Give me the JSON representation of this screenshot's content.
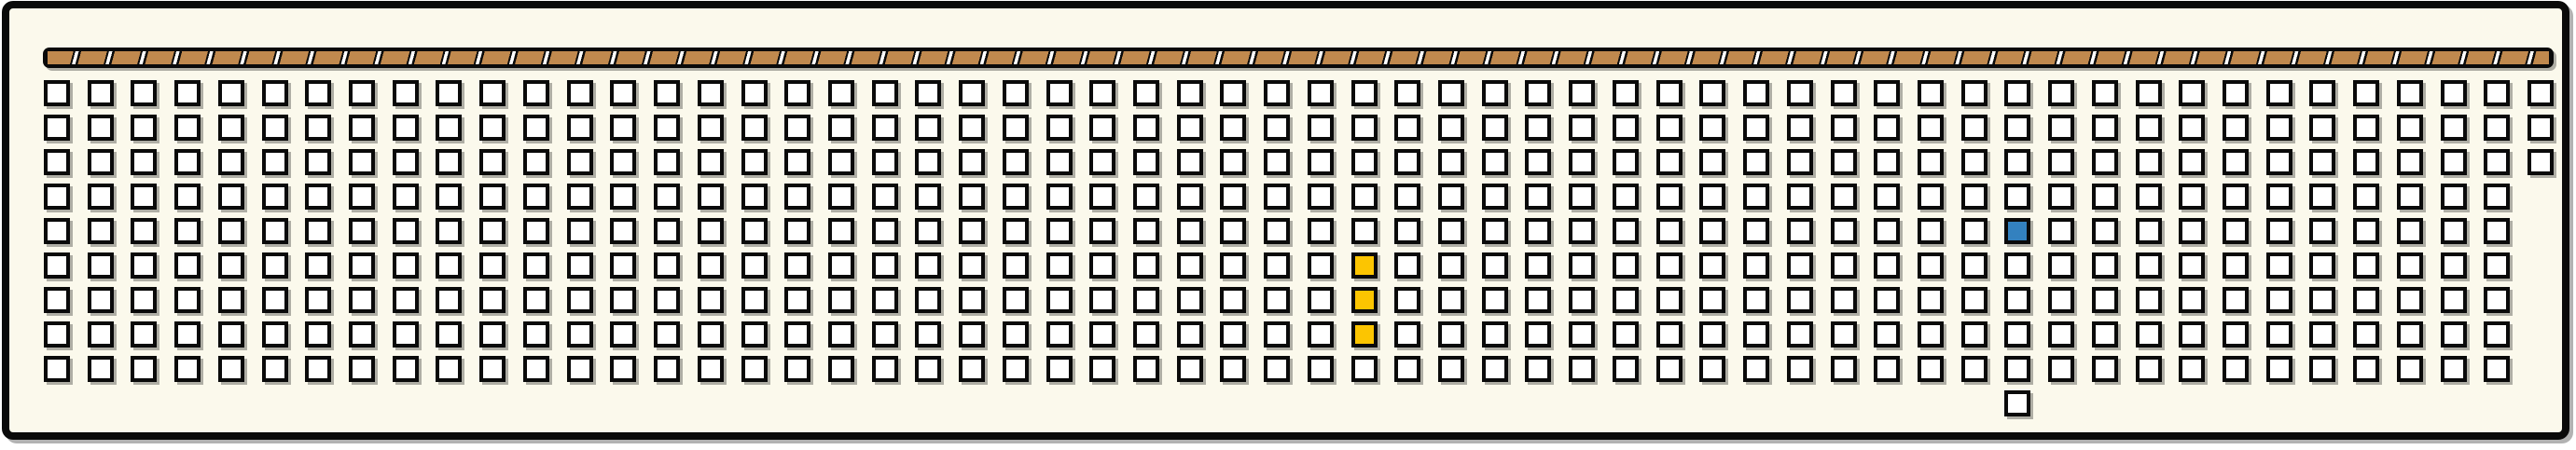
{
  "colors": {
    "background": "#ffffff",
    "panel": "#fbf9ec",
    "outline": "#0a0a0a",
    "tan": "#c0894e",
    "separator": "#ffffff",
    "cell_fill": "#ffffff",
    "yellow": "#fcc501",
    "blue": "#3381bf",
    "shadow": "rgba(0,0,0,0.30)"
  },
  "tape_strip": {
    "segments": 77,
    "segment_color": "#c0894e",
    "separator_color": "#ffffff"
  },
  "grid": {
    "columns": 58,
    "rows": 9,
    "short_columns": [
      {
        "column": 58,
        "rows": 3
      }
    ],
    "colored_cells": [
      {
        "column": 31,
        "row": 6,
        "color": "yellow"
      },
      {
        "column": 31,
        "row": 7,
        "color": "yellow"
      },
      {
        "column": 31,
        "row": 8,
        "color": "yellow"
      },
      {
        "column": 46,
        "row": 5,
        "color": "blue"
      }
    ],
    "extra_cells": [
      {
        "column": 46,
        "row": 10
      }
    ]
  }
}
